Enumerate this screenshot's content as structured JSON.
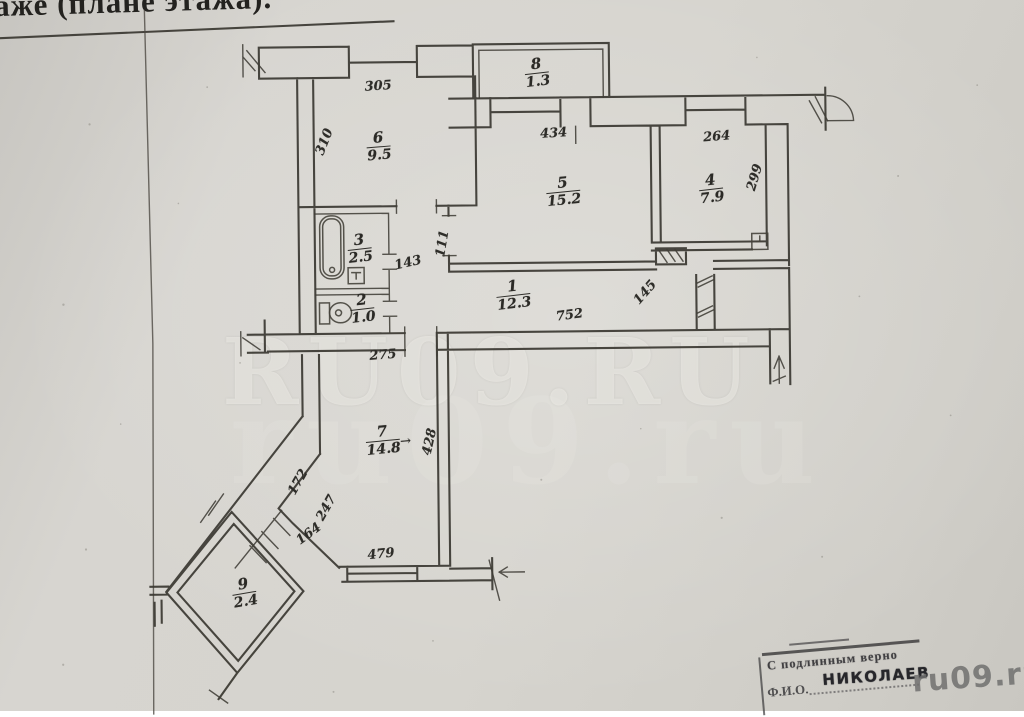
{
  "page": {
    "header_fragment": "аже (плане этажа).",
    "watermark_main": "RU09.RU",
    "watermark_ghost": "ru09.ru",
    "watermark_corner": "ru09.ru"
  },
  "stamp": {
    "line1": "С подлинным верно",
    "fio_label": "Ф.И.О.",
    "name": "Николаев"
  },
  "colors": {
    "ink": "#3a3731",
    "paper": "#d5d3cd"
  },
  "rooms": [
    {
      "num": "6",
      "area": "9.5",
      "x": 381,
      "y": 145,
      "rot": -4,
      "arrow": false
    },
    {
      "num": "8",
      "area": "1.3",
      "x": 540,
      "y": 73,
      "rot": -6,
      "arrow": false
    },
    {
      "num": "5",
      "area": "15.2",
      "x": 565,
      "y": 192,
      "rot": -5,
      "arrow": false
    },
    {
      "num": "4",
      "area": "7.9",
      "x": 713,
      "y": 191,
      "rot": -6,
      "arrow": false
    },
    {
      "num": "3",
      "area": "2.5",
      "x": 361,
      "y": 247,
      "rot": -6,
      "arrow": false
    },
    {
      "num": "2",
      "area": "1.0",
      "x": 363,
      "y": 307,
      "rot": -6,
      "arrow": false
    },
    {
      "num": "1",
      "area": "12.3",
      "x": 514,
      "y": 295,
      "rot": -6,
      "arrow": false
    },
    {
      "num": "7",
      "area": "14.8",
      "x": 382,
      "y": 439,
      "rot": -5,
      "arrow": true
    },
    {
      "num": "9",
      "area": "2.4",
      "x": 242,
      "y": 590,
      "rot": -9,
      "arrow": false
    }
  ],
  "dims": [
    {
      "text": "305",
      "x": 381,
      "y": 85,
      "rot": -3
    },
    {
      "text": "310",
      "x": 327,
      "y": 140,
      "rot": -68
    },
    {
      "text": "434",
      "x": 556,
      "y": 134,
      "rot": -3
    },
    {
      "text": "264",
      "x": 719,
      "y": 139,
      "rot": -4
    },
    {
      "text": "299",
      "x": 757,
      "y": 180,
      "rot": -73
    },
    {
      "text": "143",
      "x": 409,
      "y": 262,
      "rot": -12
    },
    {
      "text": "111",
      "x": 444,
      "y": 243,
      "rot": -80
    },
    {
      "text": "752",
      "x": 570,
      "y": 316,
      "rot": -7
    },
    {
      "text": "145",
      "x": 646,
      "y": 294,
      "rot": -48
    },
    {
      "text": "275",
      "x": 383,
      "y": 354,
      "rot": -4
    },
    {
      "text": "428",
      "x": 429,
      "y": 441,
      "rot": -77
    },
    {
      "text": "172",
      "x": 297,
      "y": 480,
      "rot": -60
    },
    {
      "text": "247",
      "x": 325,
      "y": 506,
      "rot": -60
    },
    {
      "text": "164",
      "x": 307,
      "y": 532,
      "rot": -36
    },
    {
      "text": "479",
      "x": 379,
      "y": 553,
      "rot": -5
    }
  ]
}
